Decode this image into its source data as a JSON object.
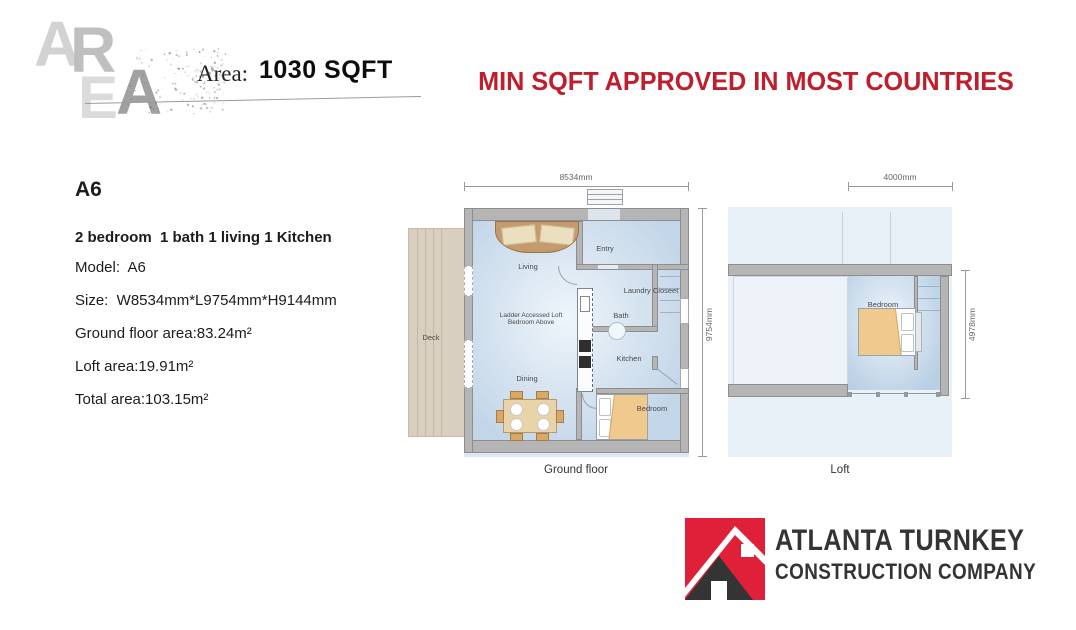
{
  "palette": {
    "headline_red": "#bf1f2c",
    "logo_red": "#e02038",
    "logo_dark": "#343434",
    "wall_gray": "#b5b5b5",
    "floor_blue": "#c3d6e8",
    "deck_beige": "#d9cfc0",
    "bed_tan": "#f0c98e"
  },
  "header": {
    "watermark_letters": [
      "A",
      "R",
      "E",
      "A"
    ],
    "area_label": "Area:",
    "area_value": "1030 SQFT",
    "headline": "MIN SQFT APPROVED IN MOST COUNTRIES"
  },
  "info": {
    "model_code": "A6",
    "summary": "2 bedroom  1 bath 1 living 1 Kitchen",
    "lines": [
      "Model:  A6",
      "Size:  W8534mm*L9754mm*H9144mm",
      "Ground floor area:83.24m²",
      "Loft area:19.91m²",
      "Total area:103.15m²"
    ]
  },
  "ground_floor": {
    "caption": "Ground floor",
    "dim_width": "8534mm",
    "dim_height": "9754mm",
    "rooms": {
      "living": "Living",
      "entry": "Entry",
      "laundry": "Laundry Closeet",
      "bath": "Bath",
      "kitchen": "Kitchen",
      "dining": "Dining",
      "bedroom": "Bedroom",
      "deck": "Deck"
    },
    "note_line1": "Ladder Accessed Loft",
    "note_line2": "Bedroom Above"
  },
  "loft": {
    "caption": "Loft",
    "dim_width": "4000mm",
    "dim_height": "4978mm",
    "rooms": {
      "bedroom": "Bedroom"
    }
  },
  "logo": {
    "name_line1": "ATLANTA TURNKEY",
    "name_line2": "CONSTRUCTION COMPANY"
  }
}
